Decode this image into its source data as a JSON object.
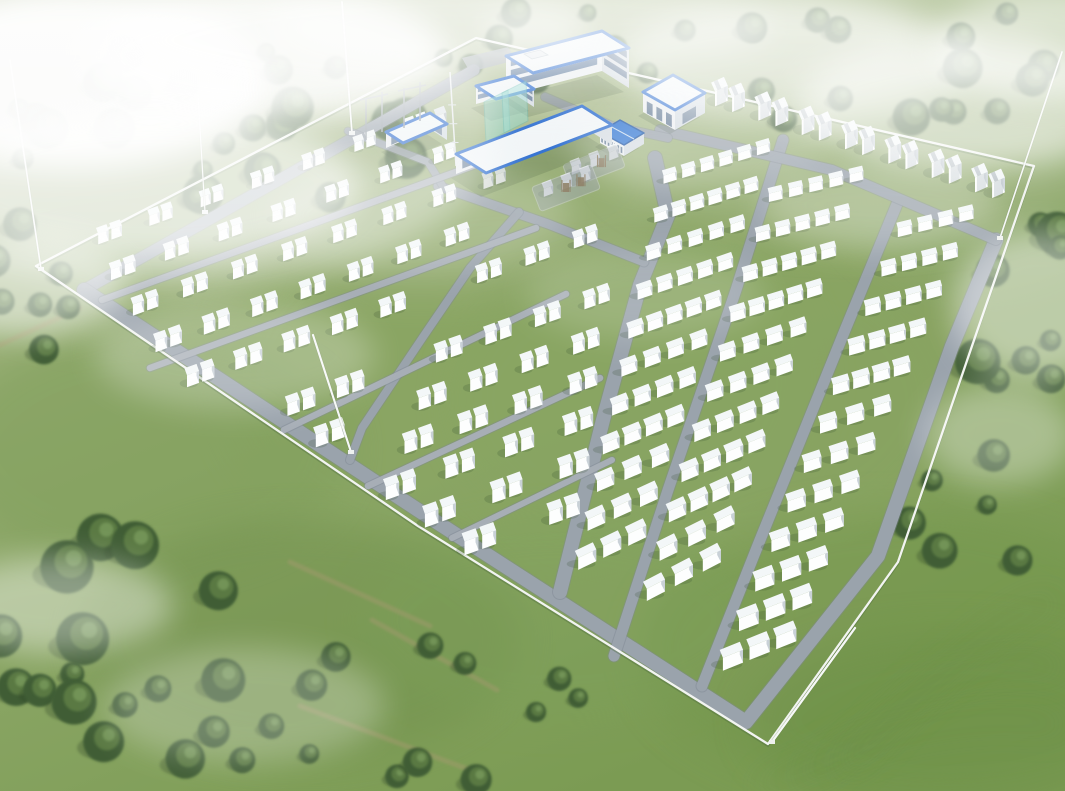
{
  "scene": {
    "kind": "aerial-rendering-battery-storage-plant",
    "canvas": {
      "w": 1065,
      "h": 791
    }
  },
  "palette": {
    "grass_top": "#b6c29d",
    "grass_mid": "#94ac70",
    "grass_low": "#7b9b53",
    "compound_grass": "#8aa361",
    "patch_dark": "#6d8d4b",
    "patch_light": "#aebb85",
    "road": "#9aa3ac",
    "road_edge": "#7e8892",
    "road_light": "#a7aeb6",
    "fence": "#f2f4f1",
    "fence_shadow": "#4e6b3e",
    "box_top": "#f3f7f8",
    "box_front": "#fdfefe",
    "box_side": "#c9d1d7",
    "box_shadow": "#33492c",
    "tree_dark": "#3f5d36",
    "tree_mid": "#5d7d45",
    "tree_light": "#789a5c",
    "roof_white": "#f1f5f7",
    "roof_trim": "#2f6fd0",
    "roof_blue": "#2e74d2",
    "wall_front": "#eceff1",
    "wall_side": "#d5dce2",
    "window": "#4a6a92",
    "teal_glass": "#8fd8cf",
    "gear_gray": "#97a0a6",
    "rust": "#8a7a5f",
    "trail": "#a69a6f",
    "mow": "#6c8f49",
    "fog": "#ffffff"
  },
  "fence": {
    "points": [
      [
        36,
        266
      ],
      [
        476,
        38
      ],
      [
        1034,
        166
      ],
      [
        972,
        346
      ],
      [
        898,
        562
      ],
      [
        768,
        744
      ],
      [
        418,
        526
      ]
    ]
  },
  "roads": [
    {
      "name": "perimeter-road-topleft",
      "pts": [
        [
          474,
          70
        ],
        [
          84,
          290
        ]
      ],
      "w": 11
    },
    {
      "name": "perimeter-road-main",
      "pts": [
        [
          84,
          290
        ],
        [
          418,
          510
        ],
        [
          746,
          722
        ],
        [
          878,
          556
        ],
        [
          952,
          346
        ],
        [
          996,
          240
        ]
      ],
      "w": 14
    },
    {
      "name": "central-road",
      "pts": [
        [
          655,
          158
        ],
        [
          668,
          215
        ],
        [
          640,
          285
        ],
        [
          603,
          420
        ],
        [
          560,
          592
        ]
      ],
      "w": 14
    },
    {
      "name": "right-road-1",
      "pts": [
        [
          783,
          140
        ],
        [
          736,
          290
        ],
        [
          668,
          490
        ],
        [
          614,
          656
        ]
      ],
      "w": 11
    },
    {
      "name": "right-road-2",
      "pts": [
        [
          897,
          204
        ],
        [
          845,
          330
        ],
        [
          760,
          540
        ],
        [
          702,
          686
        ]
      ],
      "w": 11
    },
    {
      "name": "top-connector-road",
      "pts": [
        [
          660,
          130
        ],
        [
          832,
          170
        ],
        [
          996,
          240
        ]
      ],
      "w": 10
    },
    {
      "name": "campus-road-1",
      "pts": [
        [
          438,
          186
        ],
        [
          548,
          224
        ],
        [
          644,
          262
        ]
      ],
      "w": 9
    },
    {
      "name": "campus-road-2",
      "pts": [
        [
          545,
          97
        ],
        [
          612,
          126
        ],
        [
          668,
          138
        ]
      ],
      "w": 8
    },
    {
      "name": "campus-road-3",
      "pts": [
        [
          348,
          131
        ],
        [
          428,
          162
        ],
        [
          444,
          188
        ]
      ],
      "w": 7
    },
    {
      "name": "left-cross-road",
      "pts": [
        [
          519,
          212
        ],
        [
          470,
          268
        ],
        [
          423,
          337
        ],
        [
          362,
          428
        ],
        [
          350,
          460
        ]
      ],
      "w": 8
    },
    {
      "name": "row-road-1",
      "pts": [
        [
          102,
          300
        ],
        [
          500,
          156
        ]
      ],
      "w": 6.5,
      "light": true
    },
    {
      "name": "row-road-2",
      "pts": [
        [
          150,
          368
        ],
        [
          536,
          228
        ]
      ],
      "w": 6.5,
      "light": true
    },
    {
      "name": "row-road-3",
      "pts": [
        [
          284,
          430
        ],
        [
          566,
          294
        ]
      ],
      "w": 6.5,
      "light": true
    },
    {
      "name": "row-road-4",
      "pts": [
        [
          368,
          486
        ],
        [
          600,
          378
        ]
      ],
      "w": 6.5,
      "light": true
    },
    {
      "name": "row-road-5",
      "pts": [
        [
          452,
          538
        ],
        [
          612,
          460
        ]
      ],
      "w": 6,
      "light": true
    }
  ],
  "left_block": {
    "rows": [
      [
        84,
        246,
        440,
        118,
        7
      ],
      [
        96,
        282,
        470,
        148,
        7
      ],
      [
        116,
        318,
        522,
        172,
        8
      ],
      [
        140,
        354,
        532,
        212,
        8
      ],
      [
        168,
        390,
        616,
        230,
        9
      ],
      [
        276,
        416,
        620,
        293,
        7
      ],
      [
        308,
        446,
        606,
        339,
        6
      ],
      [
        345,
        471,
        600,
        380,
        5
      ],
      [
        385,
        496,
        592,
        422,
        4
      ],
      [
        428,
        522,
        584,
        466,
        3
      ],
      [
        472,
        548,
        570,
        513,
        2
      ]
    ],
    "slab": {
      "w": 15,
      "d": 11,
      "h": 14,
      "gap": 4
    },
    "avoid_road": "left-cross-road",
    "avoid_dist": 15
  },
  "right_block": {
    "box": {
      "w": 22,
      "d": 10,
      "h": 12,
      "pitch": 28
    },
    "sections": [
      {
        "name": "section-a",
        "lt": [
          660,
          182
        ],
        "lb": [
          573,
          568
        ],
        "rt": [
          772,
          148
        ],
        "rb": [
          648,
          532
        ],
        "trains": 11
      },
      {
        "name": "section-b",
        "lt": [
          765,
          200
        ],
        "lb": [
          640,
          600
        ],
        "rt": [
          866,
          176
        ],
        "rb": [
          724,
          556
        ],
        "trains": 11
      },
      {
        "name": "section-c",
        "lt": [
          894,
          235
        ],
        "lb": [
          718,
          668
        ],
        "rt": [
          976,
          215
        ],
        "rb": [
          798,
          636
        ],
        "trains": 12
      }
    ]
  },
  "pcs_row": {
    "from": [
      728,
      102
    ],
    "to": [
      988,
      188
    ],
    "pairs": 7,
    "unit": {
      "w": 14,
      "d": 12,
      "h": 15
    },
    "scale": 0.72
  },
  "buildings": [
    {
      "name": "substation-building",
      "A": [
        386,
        148
      ],
      "U": [
        44,
        -19
      ],
      "V": [
        17,
        11
      ],
      "h": 16,
      "roof": "trim",
      "win": "arches"
    },
    {
      "name": "workshop-long-building",
      "A": [
        456,
        174
      ],
      "U": [
        126,
        -48
      ],
      "V": [
        30,
        19
      ],
      "h": 20,
      "roof": "trim",
      "win": "small"
    },
    {
      "name": "admin-main-building",
      "A": [
        506,
        96
      ],
      "U": [
        96,
        -25
      ],
      "V": [
        27,
        17
      ],
      "h": 40,
      "roof": "trim",
      "win": "bands"
    },
    {
      "name": "admin-wing",
      "A": [
        476,
        104
      ],
      "U": [
        38,
        -10
      ],
      "V": [
        20,
        13
      ],
      "h": 18,
      "roof": "trim",
      "win": "bands2"
    },
    {
      "name": "auxiliary-building",
      "A": [
        643,
        112
      ],
      "U": [
        32,
        18
      ],
      "V": [
        30,
        -17
      ],
      "h": 20,
      "roof": "trim",
      "win": "arches"
    },
    {
      "name": "pump-house",
      "A": [
        600,
        143
      ],
      "U": [
        24,
        13
      ],
      "V": [
        20,
        -12
      ],
      "h": 11,
      "roof": "blue",
      "win": "small"
    }
  ],
  "courtyard_pad": {
    "pts": [
      [
        462,
        58
      ],
      [
        508,
        47
      ],
      [
        516,
        60
      ],
      [
        470,
        72
      ]
    ]
  },
  "equipment_pads": [
    {
      "cx": 566,
      "cy": 188,
      "w": 64,
      "h": 26,
      "ang": -21,
      "boxes": 3,
      "frames": 2
    },
    {
      "cx": 594,
      "cy": 166,
      "w": 58,
      "h": 24,
      "ang": -21,
      "boxes": 3,
      "frames": 1
    }
  ],
  "substation": {
    "frames": [
      "M366,140L366,98",
      "M382,132L382,92",
      "M360,100L388,94",
      "M404,128L404,88",
      "M420,121L420,82",
      "M398,91L426,85"
    ],
    "transformers": [
      [
        408,
        136
      ],
      [
        424,
        128
      ],
      [
        440,
        120
      ]
    ],
    "antenna": {
      "base": [
        456,
        166
      ],
      "top": [
        450,
        72
      ]
    },
    "screens": [
      [
        [
          484,
          102
        ],
        [
          508,
          90
        ],
        [
          510,
          130
        ],
        [
          486,
          142
        ]
      ],
      [
        [
          502,
          93
        ],
        [
          526,
          81
        ],
        [
          528,
          121
        ],
        [
          504,
          133
        ]
      ]
    ]
  },
  "masts": [
    {
      "name": "lightning-mast-west",
      "x1": 41,
      "y1": 269,
      "x2": 10,
      "y2": 60,
      "w": 1.6
    },
    {
      "name": "lightning-mast-north",
      "x1": 352,
      "y1": 133,
      "x2": 342,
      "y2": 2,
      "w": 1.8
    },
    {
      "name": "lightning-mast-fence",
      "x1": 205,
      "y1": 212,
      "x2": 198,
      "y2": 95,
      "w": 1.2
    },
    {
      "name": "lightning-mast-center",
      "x1": 351,
      "y1": 452,
      "x2": 313,
      "y2": 335,
      "w": 2.1
    },
    {
      "name": "lightning-mast-east",
      "x1": 1000,
      "y1": 238,
      "x2": 1062,
      "y2": 52,
      "w": 1.6
    },
    {
      "name": "lightning-mast-south",
      "x1": 772,
      "y1": 742,
      "x2": 855,
      "y2": 628,
      "w": 2.3
    }
  ],
  "tree_clusters": [
    {
      "cx": 230,
      "cy": 120,
      "rx": 235,
      "ry": 95,
      "n": 26,
      "rmin": 9,
      "rmax": 22
    },
    {
      "cx": 560,
      "cy": 52,
      "rx": 130,
      "ry": 42,
      "n": 9,
      "rmin": 8,
      "rmax": 16
    },
    {
      "cx": 868,
      "cy": 62,
      "rx": 205,
      "ry": 72,
      "n": 17,
      "rmin": 9,
      "rmax": 20
    },
    {
      "cx": 1022,
      "cy": 295,
      "rx": 72,
      "ry": 115,
      "n": 9,
      "rmin": 10,
      "rmax": 24
    },
    {
      "cx": 988,
      "cy": 520,
      "rx": 85,
      "ry": 65,
      "n": 6,
      "rmin": 9,
      "rmax": 18
    },
    {
      "cx": 28,
      "cy": 345,
      "rx": 55,
      "ry": 125,
      "n": 7,
      "rmin": 9,
      "rmax": 18
    },
    {
      "cx": 135,
      "cy": 655,
      "rx": 185,
      "ry": 135,
      "n": 20,
      "rmin": 12,
      "rmax": 27
    },
    {
      "cx": 430,
      "cy": 705,
      "rx": 170,
      "ry": 80,
      "n": 11,
      "rmin": 7,
      "rmax": 16
    }
  ],
  "patches": [
    [
      900,
      650,
      260,
      140,
      "#74974e",
      0.55
    ],
    [
      520,
      380,
      300,
      200,
      "#8aa765",
      0.35
    ],
    [
      150,
      450,
      200,
      120,
      "#7d9c59",
      0.4
    ],
    [
      420,
      180,
      260,
      120,
      "#a3b684",
      0.45
    ],
    [
      700,
      400,
      250,
      160,
      "#87a562",
      0.3
    ],
    [
      980,
      200,
      140,
      90,
      "#93ad74",
      0.4
    ],
    [
      300,
      640,
      220,
      120,
      "#6f8f4c",
      0.45
    ],
    [
      560,
      620,
      200,
      100,
      "#7da05a",
      0.35
    ],
    [
      100,
      250,
      160,
      90,
      "#9db27e",
      0.4
    ],
    [
      500,
      60,
      560,
      80,
      "#b7c49e",
      0.7
    ],
    [
      850,
      160,
      240,
      80,
      "#a9bb8c",
      0.5
    ],
    [
      950,
      720,
      200,
      90,
      "#6e914a",
      0.5
    ]
  ],
  "trails": [
    [
      [
        0,
        345
      ],
      [
        80,
        308
      ]
    ],
    [
      [
        290,
        562
      ],
      [
        430,
        626
      ]
    ],
    [
      [
        372,
        620
      ],
      [
        497,
        690
      ]
    ],
    [
      [
        300,
        706
      ],
      [
        470,
        770
      ]
    ]
  ],
  "mow_arcs": [
    "M805,780 Q950,645 1062,668",
    "M760,790 Q930,700 1064,726",
    "M845,770 Q990,610 1058,600",
    "M585,60 L760,20",
    "M600,80 L790,38"
  ],
  "fog": [
    [
      70,
      80,
      200,
      90,
      0.95
    ],
    [
      265,
      55,
      180,
      65,
      0.8
    ],
    [
      160,
      130,
      340,
      160,
      0.4
    ],
    [
      150,
      185,
      210,
      75,
      0.6
    ],
    [
      18,
      285,
      110,
      50,
      0.55
    ],
    [
      430,
      28,
      160,
      45,
      0.5
    ],
    [
      625,
      28,
      150,
      38,
      0.42
    ],
    [
      520,
      40,
      400,
      70,
      0.3
    ],
    [
      795,
      60,
      180,
      60,
      0.55
    ],
    [
      965,
      105,
      170,
      65,
      0.6
    ],
    [
      1045,
      45,
      110,
      55,
      0.55
    ],
    [
      700,
      145,
      130,
      42,
      0.3
    ],
    [
      880,
      205,
      120,
      45,
      0.26
    ],
    [
      1038,
      305,
      85,
      75,
      0.45
    ],
    [
      1000,
      435,
      75,
      50,
      0.32
    ],
    [
      645,
      295,
      120,
      45,
      0.16
    ],
    [
      235,
      355,
      140,
      55,
      0.25
    ],
    [
      58,
      605,
      115,
      48,
      0.4
    ],
    [
      245,
      705,
      140,
      58,
      0.26
    ],
    [
      420,
      215,
      150,
      55,
      0.2
    ]
  ]
}
